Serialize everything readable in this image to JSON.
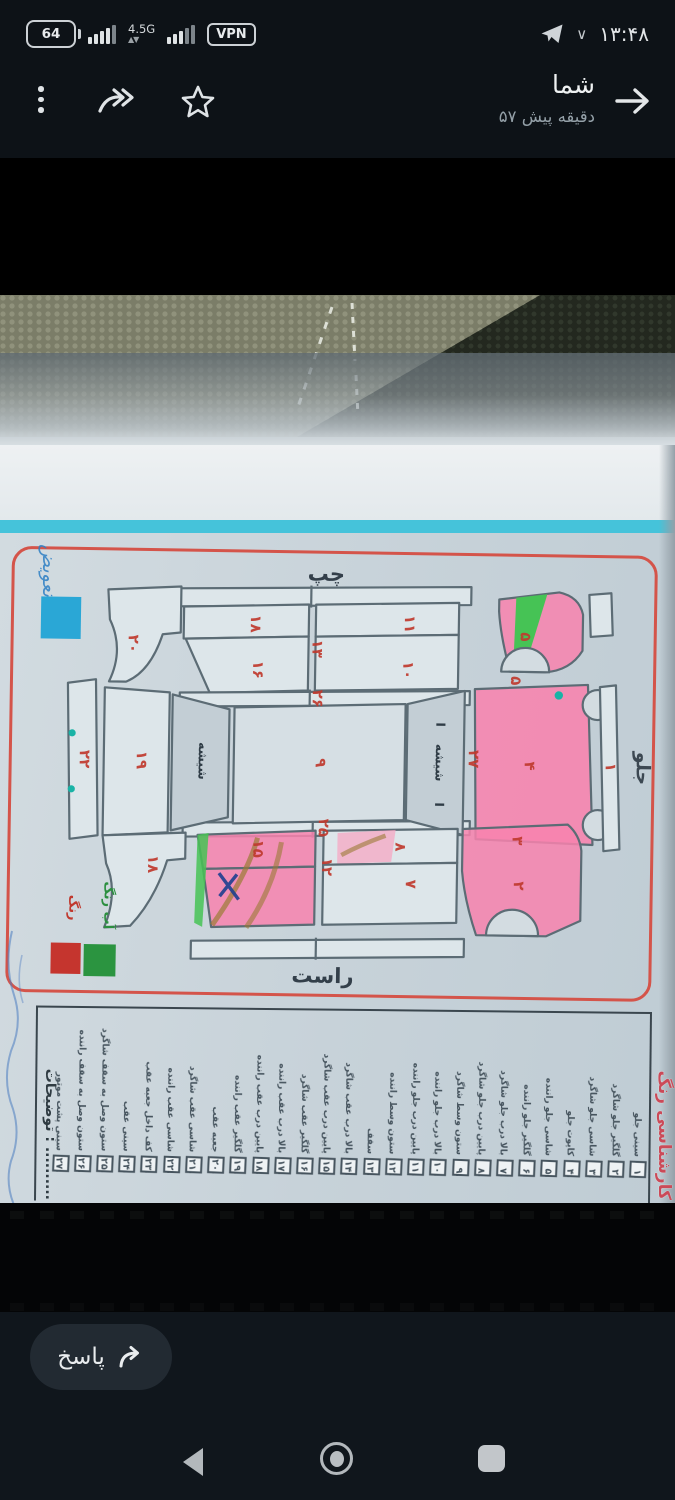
{
  "status_bar": {
    "battery": "64",
    "network": "4.5G",
    "vpn": "VPN",
    "time": "۱۳:۴۸"
  },
  "header": {
    "title": "شما",
    "subtitle": "۵۷ دقیقه پیش"
  },
  "photo": {
    "diagram": {
      "side_top": "چپ",
      "side_bottom": "راست",
      "front": "جلو",
      "glass_labels": [
        {
          "t": "شیشه",
          "x": 190,
          "y": 212
        },
        {
          "t": "شیشه",
          "x": 427,
          "y": 210
        }
      ],
      "glass_marks": [
        {
          "t": "I",
          "x": 427,
          "y": 172
        },
        {
          "t": "I",
          "x": 427,
          "y": 252
        }
      ],
      "legend": {
        "paint": "رنگ",
        "light_paint": "آب رنگ",
        "replace_note": "تعویض",
        "colors": {
          "paint": "#c5352e",
          "light_paint": "#2b9440",
          "replace": "#2aa7d6",
          "highlight": "#f883ae",
          "accent_green": "#46c355",
          "teal": "#19b3a6"
        }
      },
      "numbers": [
        {
          "t": "۲۰",
          "x": 118,
          "y": 96
        },
        {
          "t": "۱۸",
          "x": 240,
          "y": 74
        },
        {
          "t": "۱۳",
          "x": 302,
          "y": 98
        },
        {
          "t": "۱۱",
          "x": 394,
          "y": 72
        },
        {
          "t": "۱۶",
          "x": 243,
          "y": 120
        },
        {
          "t": "۱۰",
          "x": 393,
          "y": 118
        },
        {
          "t": "۵",
          "x": 510,
          "y": 83
        },
        {
          "t": "۵",
          "x": 501,
          "y": 127
        },
        {
          "t": "۲۶",
          "x": 303,
          "y": 148
        },
        {
          "t": "۲۲",
          "x": 71,
          "y": 212
        },
        {
          "t": "۱۹",
          "x": 128,
          "y": 212
        },
        {
          "t": "۹",
          "x": 307,
          "y": 212
        },
        {
          "t": "۲۷",
          "x": 460,
          "y": 206
        },
        {
          "t": "۴",
          "x": 516,
          "y": 212
        },
        {
          "t": "۱",
          "x": 597,
          "y": 212
        },
        {
          "t": "۲۵",
          "x": 311,
          "y": 277
        },
        {
          "t": "۱۵",
          "x": 246,
          "y": 299
        },
        {
          "t": "۱۲",
          "x": 315,
          "y": 316
        },
        {
          "t": "۱۸",
          "x": 141,
          "y": 316
        },
        {
          "t": "۸",
          "x": 388,
          "y": 295
        },
        {
          "t": "۷",
          "x": 399,
          "y": 332
        },
        {
          "t": "۳",
          "x": 505,
          "y": 287
        },
        {
          "t": "۲",
          "x": 507,
          "y": 332
        }
      ]
    },
    "notes_label": "توضیحات : ..........",
    "edge_text": "کارشناسی رنگ",
    "checklist": [
      {
        "no": "۱",
        "label": "سینی جلو"
      },
      {
        "no": "۲",
        "label": "گلگیر جلو شاگرد"
      },
      {
        "no": "۳",
        "label": "شاسی جلو شاگرد"
      },
      {
        "no": "۴",
        "label": "کاپوت جلو"
      },
      {
        "no": "۵",
        "label": "شاسی جلو راننده"
      },
      {
        "no": "۶",
        "label": "گلگیر جلو راننده"
      },
      {
        "no": "۷",
        "label": "بالا درب جلو شاگرد"
      },
      {
        "no": "۸",
        "label": "پایین درب جلو شاگرد"
      },
      {
        "no": "۹",
        "label": "ستون وسط شاگرد"
      },
      {
        "no": "۱۰",
        "label": "بالا درب جلو راننده"
      },
      {
        "no": "۱۱",
        "label": "پایین درب جلو راننده"
      },
      {
        "no": "۱۲",
        "label": "ستون وسط راننده"
      },
      {
        "no": "۱۳",
        "label": "سقف"
      },
      {
        "no": "۱۴",
        "label": "بالا درب عقب شاگرد"
      },
      {
        "no": "۱۵",
        "label": "پایین درب عقب شاگرد"
      },
      {
        "no": "۱۶",
        "label": "گلگیر عقب شاگرد"
      },
      {
        "no": "۱۷",
        "label": "بالا درب عقب راننده"
      },
      {
        "no": "۱۸",
        "label": "پایین درب عقب راننده"
      },
      {
        "no": "۱۹",
        "label": "گلگیر عقب راننده"
      },
      {
        "no": "۲۰",
        "label": "جعبه عقب"
      },
      {
        "no": "۲۱",
        "label": "شاسی عقب شاگرد"
      },
      {
        "no": "۲۲",
        "label": "شاسی عقب راننده"
      },
      {
        "no": "۲۳",
        "label": "کف داخل جعبه عقب"
      },
      {
        "no": "۲۴",
        "label": "سینی عقب"
      },
      {
        "no": "۲۵",
        "label": "ستون وصل به سقف شاگرد"
      },
      {
        "no": "۲۶",
        "label": "ستون وصل به سقف راننده"
      },
      {
        "no": "۲۷",
        "label": "سینی پشت موتور"
      }
    ]
  },
  "reply": {
    "label": "پاسخ"
  }
}
